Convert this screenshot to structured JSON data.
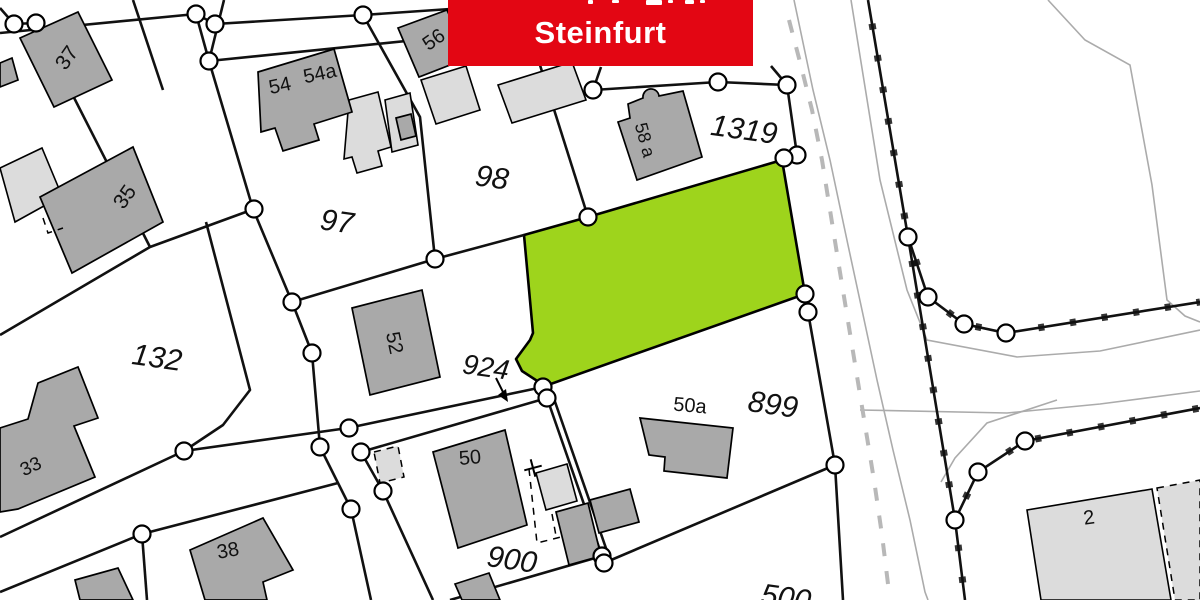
{
  "banner": {
    "text": "Steinfurt",
    "bg": "#e30613",
    "fg": "#ffffff",
    "x": 448,
    "y": 0,
    "w": 305,
    "h": 66,
    "fragments": [
      [
        588,
        0,
        5,
        4
      ],
      [
        612,
        0,
        7,
        3
      ],
      [
        646,
        0,
        16,
        5
      ],
      [
        668,
        0,
        5,
        3
      ],
      [
        685,
        0,
        9,
        4
      ],
      [
        700,
        0,
        5,
        3
      ]
    ]
  },
  "map": {
    "bg": "#ffffff",
    "colors": {
      "highlight_parcel": "#9ed41c",
      "building_dark": "#a9a9a9",
      "building_light": "#dcdcdc",
      "outline": "#000000",
      "boundary": "#111111",
      "road_edge": "#ababab",
      "road_dash": "#b8b8b8",
      "label": "#111111",
      "point_fill": "#ffffff"
    },
    "highlight_parcel": {
      "points": "524,235 588,217 782,160 805,294 545,386 522,371 516,359 530,340 533,333"
    },
    "parcel_labels": [
      {
        "text": "97",
        "x": 337,
        "y": 222,
        "size": 30,
        "rot": 8
      },
      {
        "text": "98",
        "x": 492,
        "y": 178,
        "size": 30,
        "rot": 8
      },
      {
        "text": "132",
        "x": 157,
        "y": 358,
        "size": 30,
        "rot": 8
      },
      {
        "text": "1319",
        "x": 744,
        "y": 130,
        "size": 30,
        "rot": 8
      },
      {
        "text": "924",
        "x": 486,
        "y": 367,
        "size": 28,
        "rot": 8
      },
      {
        "text": "899",
        "x": 773,
        "y": 405,
        "size": 30,
        "rot": 8
      },
      {
        "text": "900",
        "x": 512,
        "y": 560,
        "size": 30,
        "rot": 8
      },
      {
        "text": "500",
        "x": 786,
        "y": 598,
        "size": 30,
        "rot": 8
      }
    ],
    "house_labels": [
      {
        "text": "37",
        "x": 67,
        "y": 58,
        "size": 21,
        "rot": -55
      },
      {
        "text": "35",
        "x": 125,
        "y": 197,
        "size": 21,
        "rot": -55
      },
      {
        "text": "33",
        "x": 31,
        "y": 467,
        "size": 19,
        "rot": -25
      },
      {
        "text": "54",
        "x": 280,
        "y": 86,
        "size": 20,
        "rot": -12
      },
      {
        "text": "54a",
        "x": 320,
        "y": 74,
        "size": 20,
        "rot": -12
      },
      {
        "text": "56",
        "x": 434,
        "y": 40,
        "size": 20,
        "rot": -35
      },
      {
        "text": "58 a",
        "x": 645,
        "y": 140,
        "size": 18,
        "rot": 75
      },
      {
        "text": "52",
        "x": 394,
        "y": 343,
        "size": 20,
        "rot": 78
      },
      {
        "text": "50",
        "x": 470,
        "y": 458,
        "size": 20,
        "rot": -5
      },
      {
        "text": "50a",
        "x": 690,
        "y": 406,
        "size": 20,
        "rot": 5
      },
      {
        "text": "38",
        "x": 228,
        "y": 551,
        "size": 20,
        "rot": -10
      },
      {
        "text": "2",
        "x": 1089,
        "y": 518,
        "size": 20,
        "rot": -8
      }
    ],
    "buildings_dark": [
      {
        "points": "20,38 78,12 112,80 54,107"
      },
      {
        "points": "40,197 133,147 163,222 72,273"
      },
      {
        "points": "0,63 12,58 18,80 0,87"
      },
      {
        "points": "258,72 334,49 352,112 314,124 319,140 283,151 275,128 261,132"
      },
      {
        "points": "398,28 447,10 468,58 419,77"
      },
      {
        "points": "396,118 411,114 416,136 401,140"
      },
      {
        "path": "M618,122 L630,118 L628,104 L643,98 A8,8 0 0 1 659,96 L683,91 L702,157 L637,180 Z"
      },
      {
        "points": "352,308 422,290 440,377 370,395"
      },
      {
        "points": "433,452 505,430 527,525 458,548"
      },
      {
        "points": "640,418 733,428 727,478 664,471 665,457 649,455"
      },
      {
        "points": "190,550 263,518 293,570 263,582 267,600 205,600"
      },
      {
        "points": "556,512 588,503 601,556 569,565"
      },
      {
        "points": "590,500 630,489 639,522 599,533"
      },
      {
        "points": "455,584 489,573 500,600 462,600"
      },
      {
        "points": "75,580 118,568 133,600 80,600"
      },
      {
        "points": "38,383 78,367 98,418 74,426 95,477 18,509 0,512 0,428 28,419"
      }
    ],
    "buildings_light": [
      {
        "points": "0,168 42,148 62,196 15,222"
      },
      {
        "points": "349,100 378,92 391,147 378,151 382,166 357,173 352,157 344,159"
      },
      {
        "points": "385,100 410,93 418,145 392,152"
      },
      {
        "points": "421,80 466,66 480,110 436,124"
      },
      {
        "points": "498,85 572,62 586,100 512,123"
      },
      {
        "points": "536,473 567,464 577,501 546,510"
      },
      {
        "points": "1027,510 1152,489 1171,600 1041,600"
      }
    ],
    "dashed_regions": [
      {
        "points": "1157,488 1200,480 1200,600 1175,600",
        "fill": true
      },
      {
        "points": "374,452 398,446 404,477 380,483",
        "fill": true
      }
    ],
    "dashed_lines": [
      {
        "pts": "529,469 537,543 561,537"
      },
      {
        "pts": "552,514 556,536"
      },
      {
        "pts": "43,218 48,233 63,228"
      }
    ],
    "boundary_lines": [
      {
        "pts": "0,33 196,14"
      },
      {
        "pts": "196,14 215,24 363,15 450,9"
      },
      {
        "pts": "196,14 209,61"
      },
      {
        "pts": "224,0 209,61"
      },
      {
        "pts": "209,61 455,36"
      },
      {
        "pts": "133,0 163,90"
      },
      {
        "pts": "0,8 14,24 36,23"
      },
      {
        "pts": "36,23 150,247"
      },
      {
        "pts": "209,61 253,209 292,302"
      },
      {
        "pts": "292,302 312,353 320,447 351,509 371,600"
      },
      {
        "pts": "363,15 420,117 435,259"
      },
      {
        "pts": "292,302 435,259"
      },
      {
        "pts": "435,259 524,235"
      },
      {
        "pts": "539,62 588,217"
      },
      {
        "pts": "601,67 593,90"
      },
      {
        "pts": "593,90 718,82 787,85"
      },
      {
        "pts": "771,66 787,85"
      },
      {
        "pts": "787,85 797,155 784,158"
      },
      {
        "pts": "805,294 808,312"
      },
      {
        "pts": "808,312 835,465 843,600"
      },
      {
        "pts": "0,335 150,247 254,209"
      },
      {
        "pts": "206,222 250,390 223,425 184,451 0,537"
      },
      {
        "pts": "184,451 348,428"
      },
      {
        "pts": "348,428 543,387"
      },
      {
        "pts": "361,452 547,398"
      },
      {
        "pts": "361,452 383,491 433,600"
      },
      {
        "pts": "0,592 142,534 338,483"
      },
      {
        "pts": "142,534 147,600"
      },
      {
        "pts": "547,398 602,556"
      },
      {
        "pts": "553,396 608,554"
      },
      {
        "pts": "604,563 835,465"
      },
      {
        "pts": "602,556 450,600"
      }
    ],
    "tick_lines": [
      {
        "pts": "868,0 908,237"
      },
      {
        "pts": "908,237 928,297 964,324 1006,333 1200,302"
      },
      {
        "pts": "908,237 955,520 965,600"
      },
      {
        "pts": "955,520 978,472 1025,441 1200,408"
      }
    ],
    "road_edges": [
      {
        "pts": "794,0 813,90 830,160 848,245 862,310 877,380 893,450 910,520 925,592 928,600"
      },
      {
        "pts": "851,0 880,180 907,290 927,340 1017,357 1100,351 1200,330"
      },
      {
        "pts": "1048,0 1085,40 1130,65 1152,185 1167,300 1185,316 1200,322"
      },
      {
        "pts": "860,410 1007,413 1100,404 1200,391"
      },
      {
        "pts": "1057,400 987,423 955,458 941,482"
      }
    ],
    "road_dash": {
      "pts": "789,20 800,62 812,110 822,160 830,210 838,260 847,315 856,370 865,425 874,480 882,535 889,592"
    },
    "circles": [
      [
        14,
        24
      ],
      [
        36,
        23
      ],
      [
        196,
        14
      ],
      [
        215,
        24
      ],
      [
        363,
        15
      ],
      [
        209,
        61
      ],
      [
        254,
        209
      ],
      [
        292,
        302
      ],
      [
        312,
        353
      ],
      [
        320,
        447
      ],
      [
        184,
        451
      ],
      [
        142,
        534
      ],
      [
        351,
        509
      ],
      [
        361,
        452
      ],
      [
        383,
        491
      ],
      [
        435,
        259
      ],
      [
        588,
        217
      ],
      [
        593,
        90
      ],
      [
        718,
        82
      ],
      [
        787,
        85
      ],
      [
        797,
        155
      ],
      [
        784,
        158
      ],
      [
        805,
        294
      ],
      [
        808,
        312
      ],
      [
        543,
        387
      ],
      [
        547,
        398
      ],
      [
        602,
        556
      ],
      [
        604,
        563
      ],
      [
        835,
        465
      ],
      [
        908,
        237
      ],
      [
        928,
        297
      ],
      [
        964,
        324
      ],
      [
        1006,
        333
      ],
      [
        978,
        472
      ],
      [
        1025,
        441
      ],
      [
        955,
        520
      ],
      [
        349,
        428
      ]
    ],
    "arrow": {
      "line": "496,378 504,394",
      "head": "508,402 498,395 506,389"
    },
    "survey_cross": {
      "x": 533,
      "y": 468,
      "arm": 9,
      "rot": -15
    }
  }
}
